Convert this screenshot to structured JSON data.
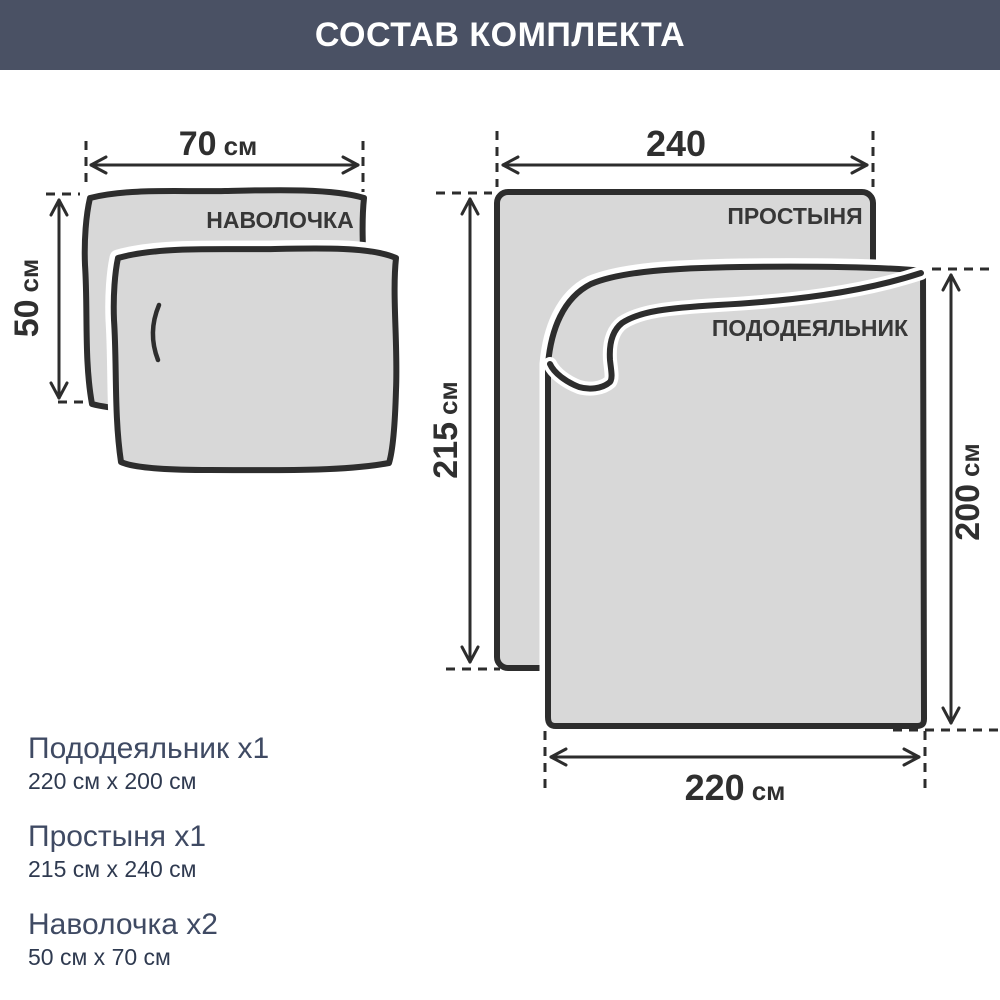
{
  "header": {
    "title": "СОСТАВ КОМПЛЕКТА",
    "bg_color": "#4A5164",
    "text_color": "#FFFFFF"
  },
  "diagram": {
    "fill_color": "#D8D8D8",
    "outline_color": "#2D2D2D",
    "pillowcase": {
      "label": "НАВОЛОЧКА",
      "width_value": "70",
      "width_unit": "см",
      "height_value": "50",
      "height_unit": "см"
    },
    "sheet": {
      "label": "ПРОСТЫНЯ",
      "width_value": "240",
      "width_unit": "",
      "height_value": "215",
      "height_unit": "см"
    },
    "duvet": {
      "label": "ПОДОДЕЯЛЬНИК",
      "width_value": "220",
      "width_unit": "см",
      "height_value": "200",
      "height_unit": "см"
    }
  },
  "legend": {
    "items": [
      {
        "name": "Пододеяльник x1",
        "size": "220 см x 200 см"
      },
      {
        "name": "Простыня x1",
        "size": "215 см x 240 см"
      },
      {
        "name": "Наволочка x2",
        "size": "50 см x 70 см"
      }
    ],
    "name_color": "#3F4A63",
    "size_color": "#2F3A50"
  }
}
